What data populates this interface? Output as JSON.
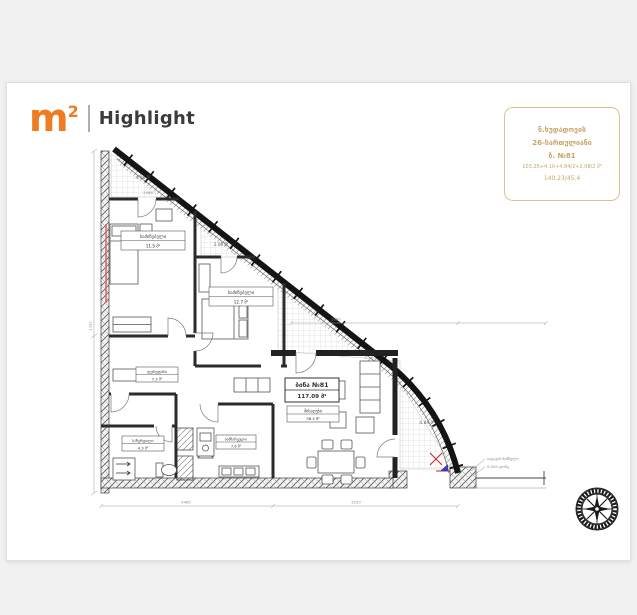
{
  "page": {
    "background": "#f0f1f0",
    "card_background": "#ffffff"
  },
  "logo": {
    "m": "m",
    "sup": "2",
    "brand": "Highlight",
    "accent_color": "#ed7c23"
  },
  "info_box": {
    "border_color": "#dcc18f",
    "text_color": "#c8a46a",
    "lines": [
      "ნ.ხუდადოვის",
      "26-სართულიანი",
      "ბ. №81",
      "103.25+4.10+4.84/2+2.08/2 მ²",
      "140.23/45.4"
    ]
  },
  "plan": {
    "apartment_box": {
      "line1": "ბინა №81",
      "line2": "117.09 მ²"
    },
    "rooms": [
      {
        "name": "საძინებელი",
        "area": "11.5 მ²"
      },
      {
        "name": "საძინებელი",
        "area": "12.7 მ²"
      },
      {
        "name": "დერეფანი",
        "area": "7.3 მ²"
      },
      {
        "name": "ს/წერტილი",
        "area": "4.3 მ²"
      },
      {
        "name": "სამზარეულო",
        "area": "7.6 მ²"
      },
      {
        "name": "მისაღები",
        "area": "38.5 მ²"
      }
    ],
    "balconies": [
      {
        "area": "4.08 მ²"
      },
      {
        "area": "2.08 მ²"
      },
      {
        "area": "4.84 მ²"
      }
    ],
    "annotation": {
      "line1": "იატაკის ნიშნული",
      "line2": "0.000 დონე"
    },
    "dims": [
      "2986",
      "3220",
      "4465",
      "1757",
      "2090"
    ]
  }
}
